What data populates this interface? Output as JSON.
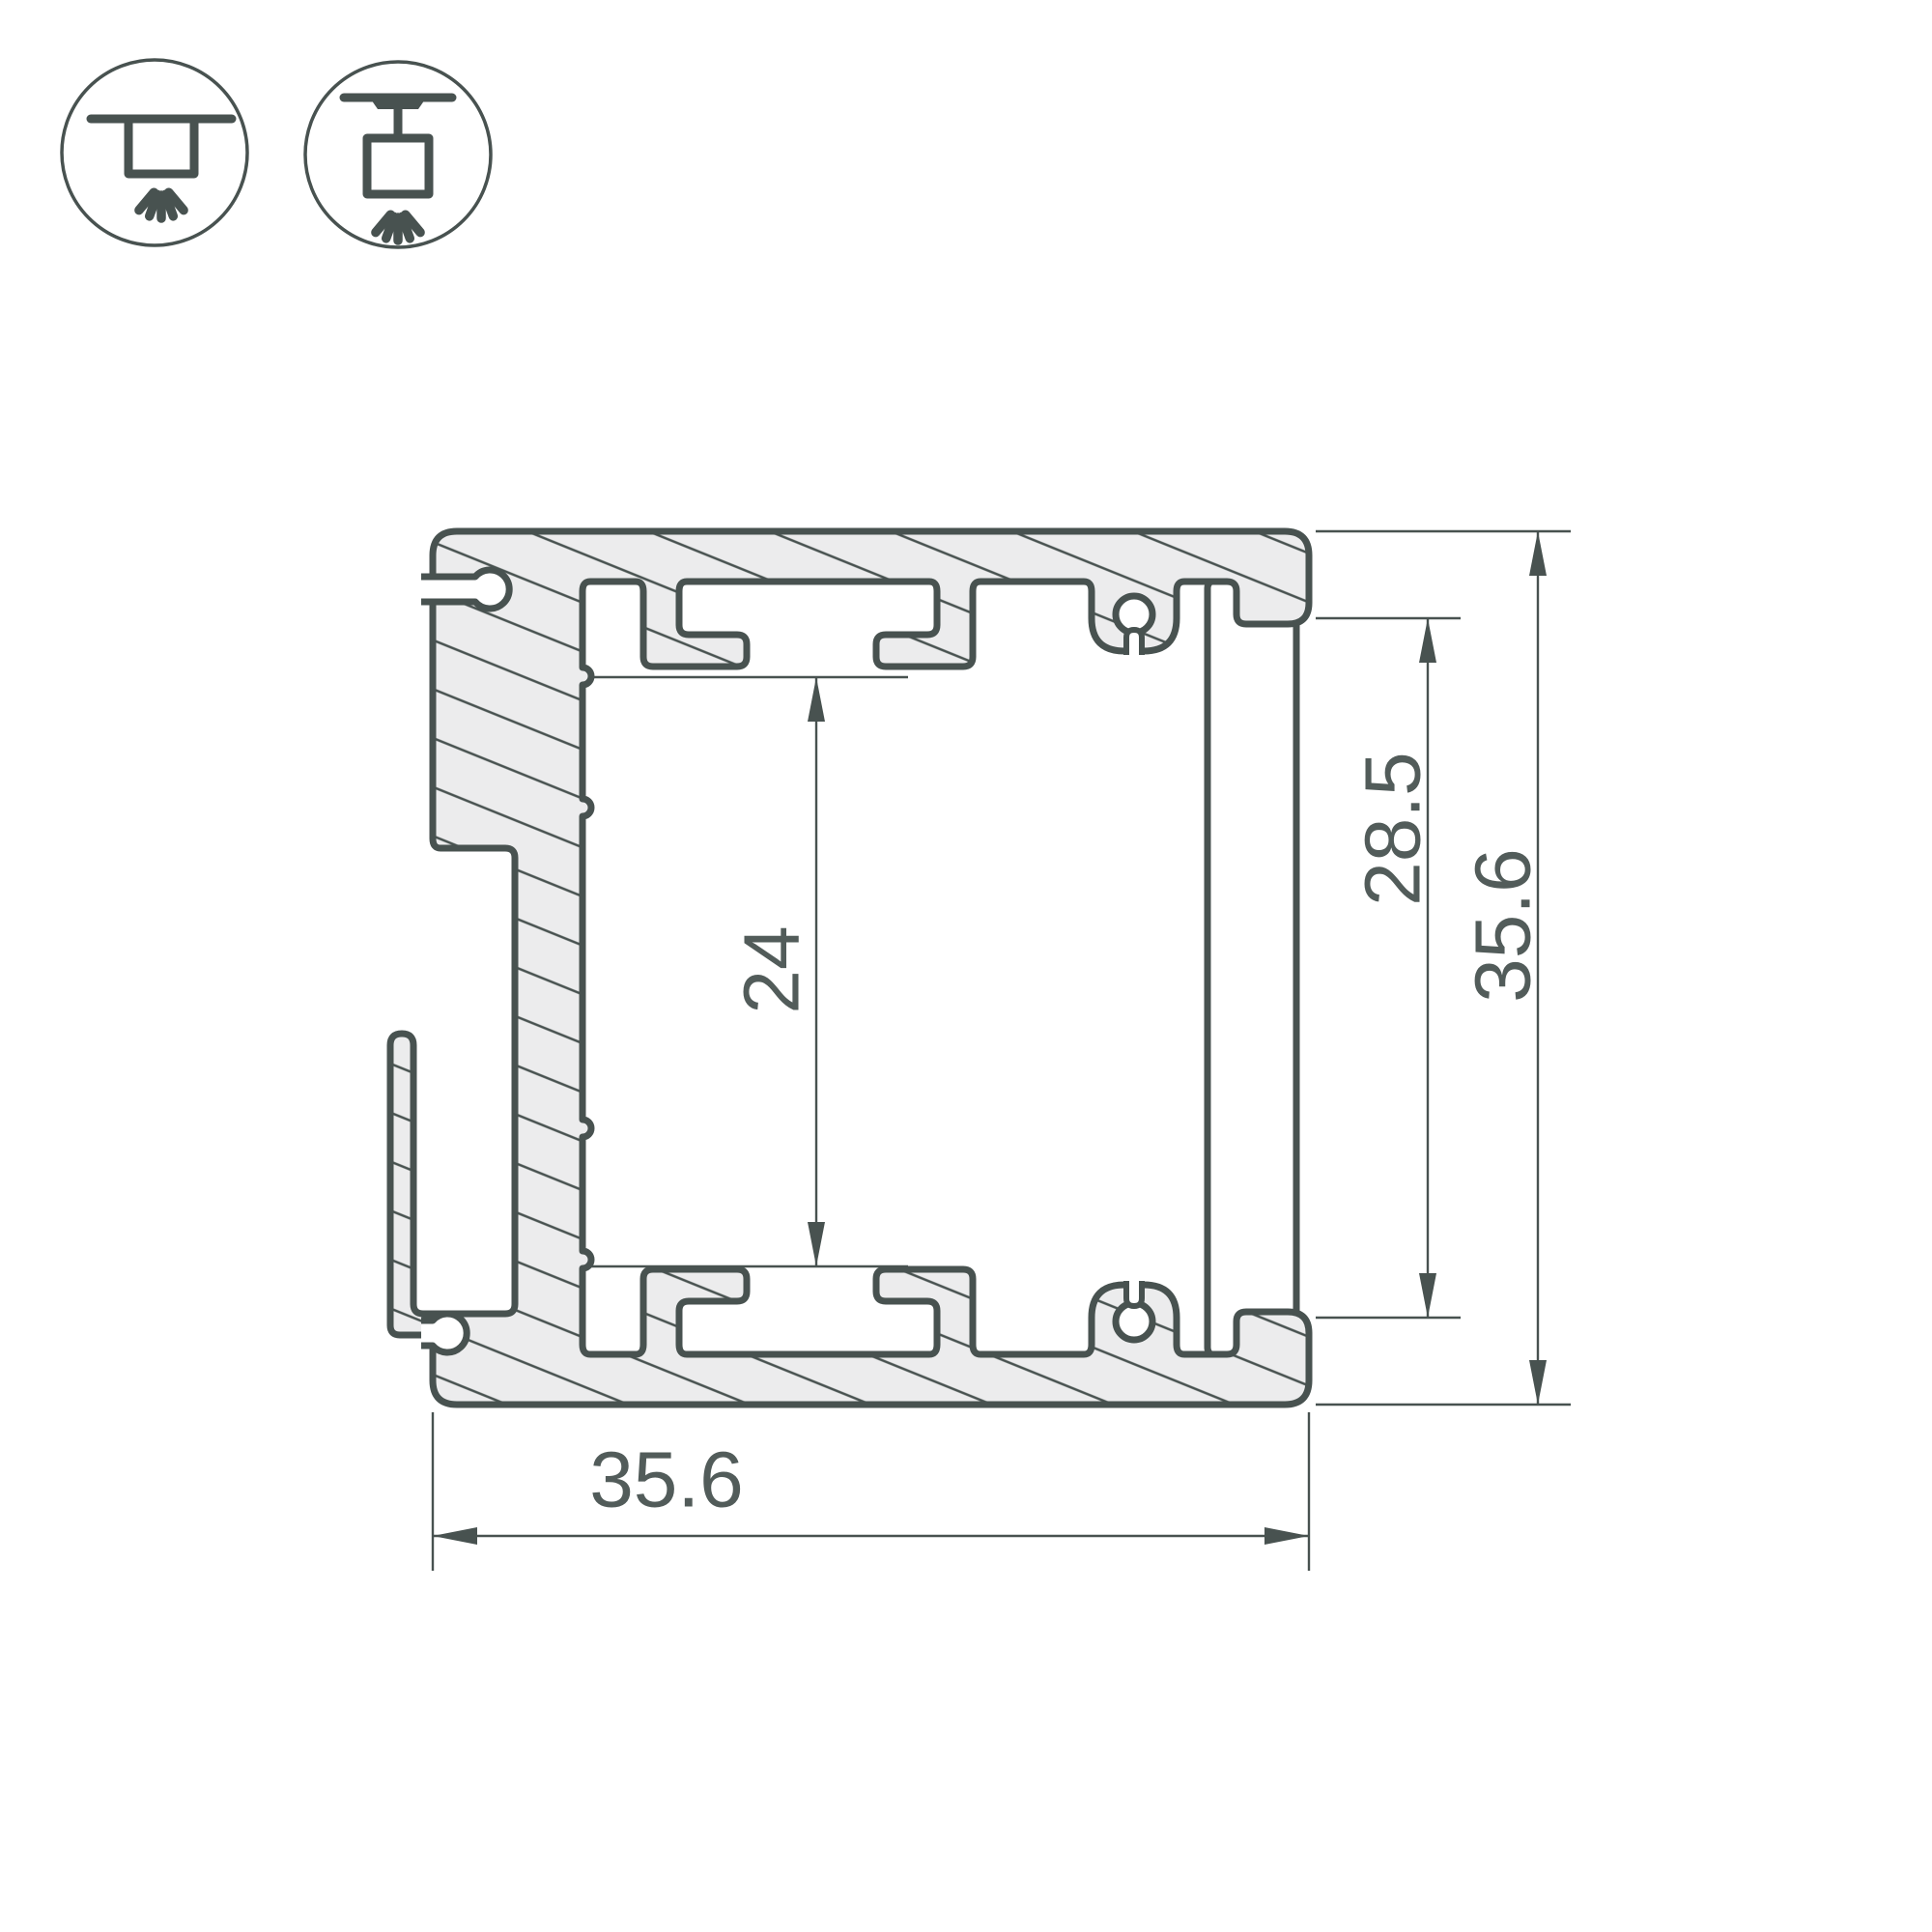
{
  "drawing": {
    "title": "aluminium-profile-cross-section",
    "dimensions": {
      "overall_width": "35.6",
      "overall_height": "35.6",
      "cover_height": "28.5",
      "inner_height": "24"
    },
    "colors": {
      "outline": "#485250",
      "material_fill": "#ECECED",
      "dimension_lines": "#485250",
      "dimension_text": "#525C5A",
      "background": "#FFFFFF"
    }
  },
  "icons": [
    {
      "name": "surface-mount-icon",
      "meaning": "surface ceiling mount luminaire"
    },
    {
      "name": "pendant-mount-icon",
      "meaning": "suspended ceiling mount luminaire"
    }
  ]
}
